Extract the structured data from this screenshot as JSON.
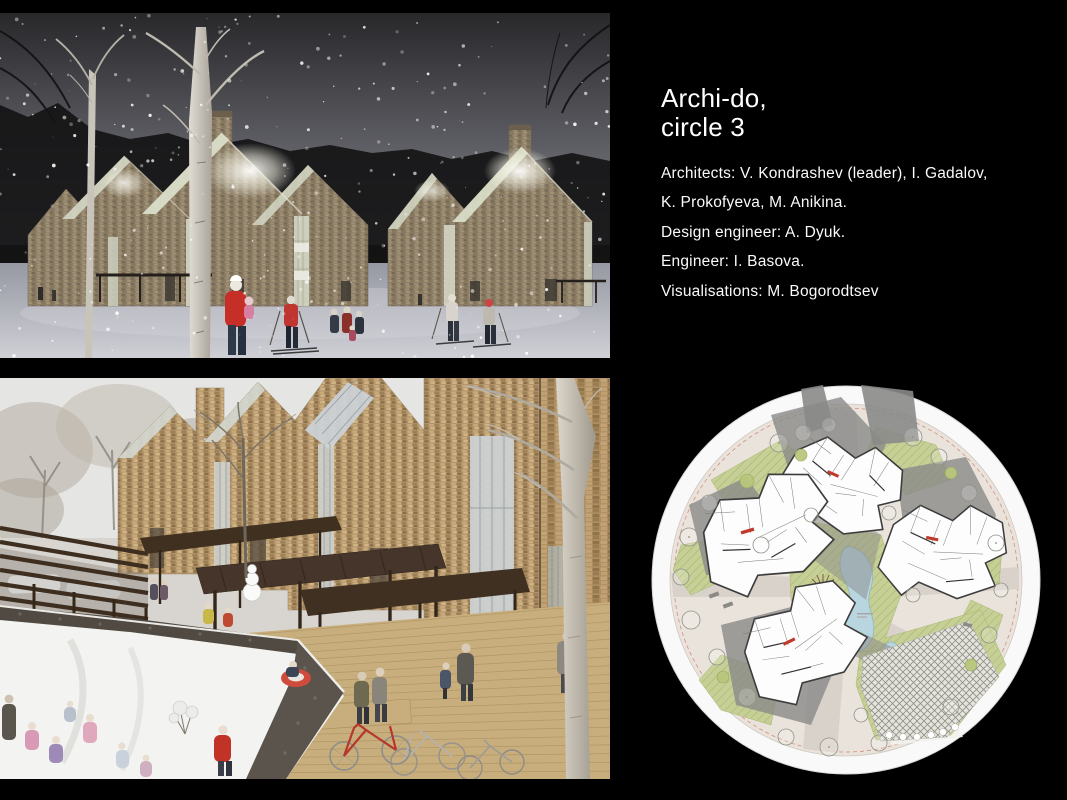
{
  "slide": {
    "background_color": "#000000",
    "text_color": "#ffffff",
    "title": {
      "line1": "Archi-do,",
      "line2": "circle 3"
    },
    "credits": [
      "Architects: V. Kondrashev (leader), I. Gadalov,",
      "K. Prokofyeva, M. Anikina.",
      "Design engineer: A. Dyuk.",
      "Engineer: I. Basova.",
      "Visualisations: M. Bogorodtsev"
    ],
    "images": {
      "top": {
        "alt": "Night winter rendering: shingle-clad gabled houses with glowing glass roof inserts, skiers in falling snow"
      },
      "bottom": {
        "alt": "Day winter rendering: timber shingle houses, wooden canopies and boardwalk, bicycles, children sledding"
      },
      "plan": {
        "alt": "Circular master plan: four housing clusters, central pond, lawns and trellis court"
      }
    },
    "palette": {
      "night_sky": "#2b2b2e",
      "shingle_wood": "#8a7c66",
      "warm_wood": "#b3946a",
      "accent_red": "#c23327",
      "plan_green": "#c6d096",
      "plan_pond": "#b9d6e0",
      "plan_site": "#eae3dc"
    }
  }
}
